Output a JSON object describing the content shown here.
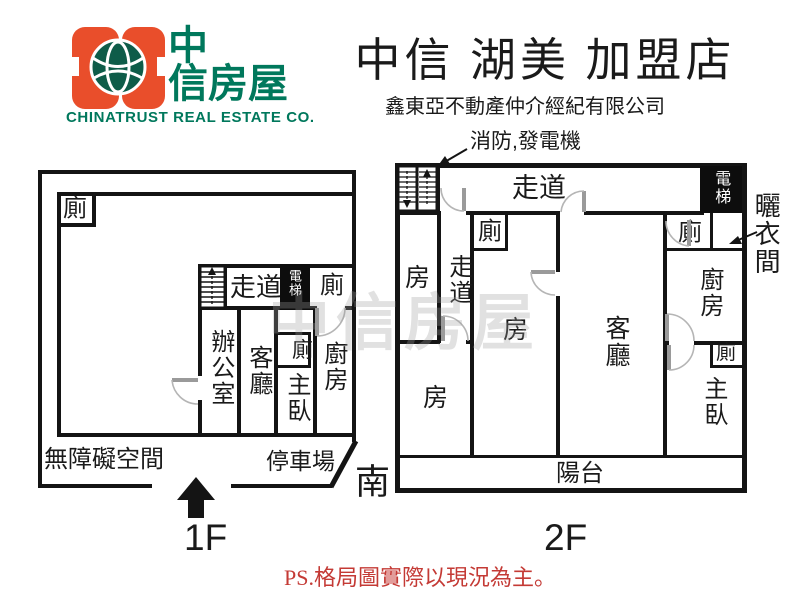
{
  "header": {
    "logo": {
      "brand_cn_line1": "中",
      "brand_cn_line2": "信房屋",
      "brand_en": "CHINATRUST REAL ESTATE CO."
    },
    "title": "中信 湖美 加盟店",
    "subtitle": "鑫東亞不動產仲介經紀有限公司"
  },
  "annotations": {
    "fire_generator": "消防,發電機",
    "laundry_room": "曬衣間",
    "south": "南",
    "floor1_label": "1F",
    "floor2_label": "2F",
    "ps_note": "PS.格局圖實際以現況為主。",
    "watermark": "中信房屋"
  },
  "f1": {
    "toilet_topleft": "廁",
    "corridor": "走道",
    "elevator": "電梯",
    "toilet_corridor": "廁",
    "office": "辦公室",
    "living": "客廳",
    "toilet_inner": "廁",
    "master": "主臥",
    "kitchen": "廚房",
    "barrier_free": "無障礙空間",
    "parking": "停車場"
  },
  "f2": {
    "corridor_top": "走道",
    "elevator": "電梯",
    "toilet_mid": "廁",
    "room_topleft": "房",
    "corridor_left": "走道",
    "room_bottomleft": "房",
    "room_mid": "房",
    "living": "客廳",
    "toilet_right": "廁",
    "kitchen": "廚房",
    "toilet_master": "廁",
    "master": "主臥",
    "balcony": "陽台"
  },
  "colors": {
    "brand_orange": "#E94E2B",
    "brand_green": "#00785C",
    "note_red": "#C43A35",
    "line_black": "#141414",
    "door_gray": "#9A9A9A"
  }
}
